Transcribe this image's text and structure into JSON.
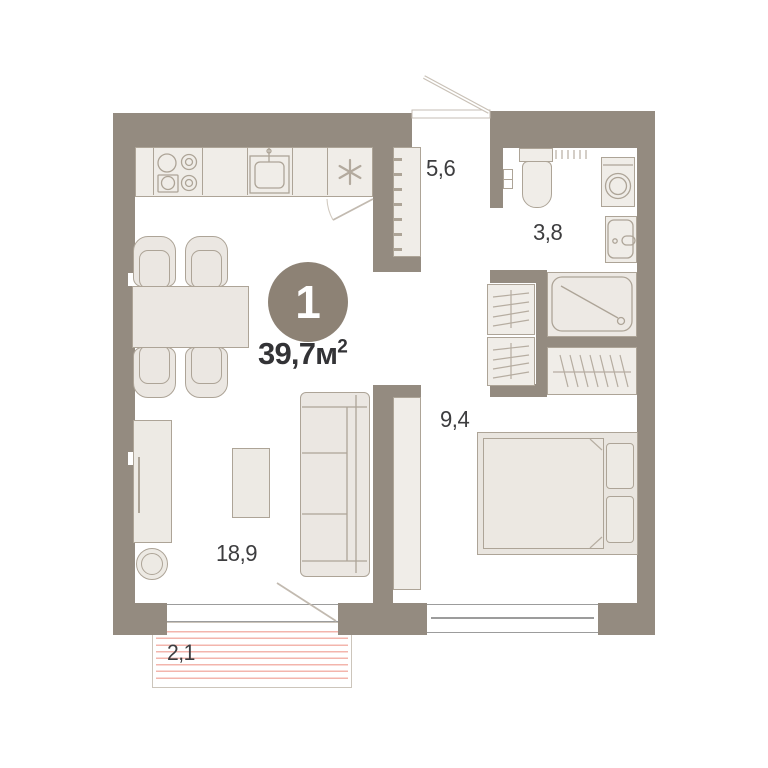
{
  "badge": {
    "number": "1",
    "area": "39,7",
    "unit": "м",
    "power": "2"
  },
  "rooms": {
    "hallway": "5,6",
    "bathroom": "3,8",
    "bedroom": "9,4",
    "living": "18,9",
    "balcony": "2,1"
  },
  "colors": {
    "wall": "#948B80",
    "fill": "#EBE7E2",
    "fill_light": "#F0EDE8",
    "stroke": "#ADA497",
    "badge_bg": "#8D8275",
    "text": "#3D3D3F",
    "balcony_stripe": "#F3B5AC",
    "door_line": "#C2BAB0",
    "window_line": "#9C9C9C"
  }
}
